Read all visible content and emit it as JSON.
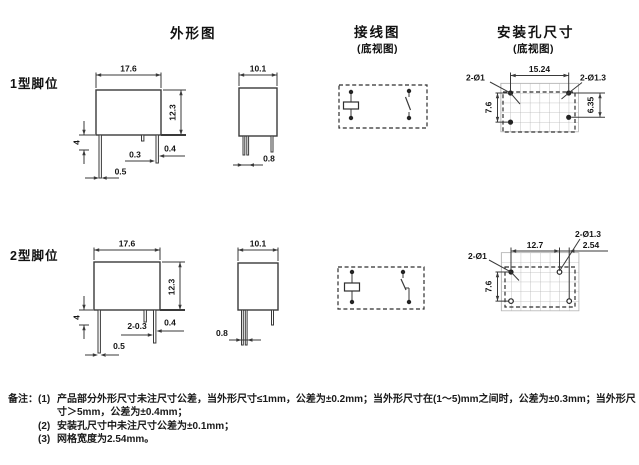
{
  "header": {
    "outline_title": "外形图",
    "wiring_title": "接线图",
    "wiring_subtitle": "(底视图)",
    "mounting_title": "安装孔尺寸",
    "mounting_subtitle": "(底视图)"
  },
  "row1": {
    "label": "1型脚位",
    "front": {
      "width": "17.6",
      "height": "12.3",
      "standoff": "4",
      "pin_dim_a": "0.3",
      "pin_dim_b": "0.4",
      "pin_dim_c": "0.5"
    },
    "side": {
      "width": "10.1",
      "pin_width": "0.8"
    },
    "mount": {
      "label_small_holes": "2-Ø1",
      "label_large_holes": "2-Ø1.3",
      "pitch": "15.24",
      "left_pitch": "7.6",
      "right_pitch": "6.35"
    }
  },
  "row2": {
    "label": "2型脚位",
    "front": {
      "width": "17.6",
      "height": "12.3",
      "standoff": "4",
      "pin_dim_a": "2-0.3",
      "pin_dim_b": "0.4",
      "pin_dim_c": "0.5"
    },
    "side": {
      "width": "10.1",
      "pin_width": "0.8"
    },
    "mount": {
      "label_small_holes": "2-Ø1",
      "label_large_holes": "2-Ø1.3",
      "pitch": "12.7",
      "offset": "2.54",
      "left_pitch": "7.6"
    }
  },
  "notes": {
    "label": "备注：",
    "items": [
      {
        "num": "(1)",
        "text": "产品部分外形尺寸未注尺寸公差，当外形尺寸≤1mm，公差为±0.2mm；当外形尺寸在(1～5)mm之间时，公差为±0.3mm；当外形尺寸＞5mm，公差为±0.4mm；"
      },
      {
        "num": "(2)",
        "text": "安装孔尺寸中未注尺寸公差为±0.1mm；"
      },
      {
        "num": "(3)",
        "text": "网格宽度为2.54mm。"
      }
    ]
  }
}
